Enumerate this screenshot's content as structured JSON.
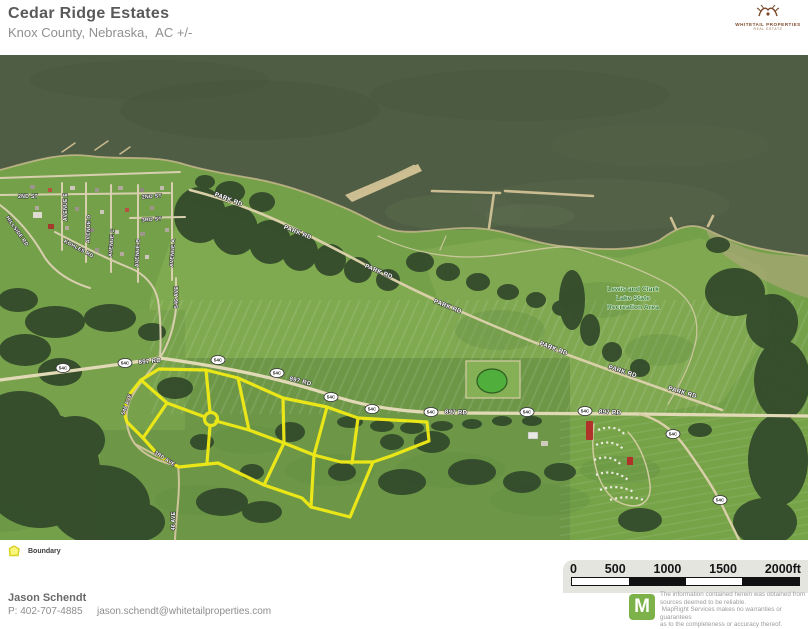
{
  "colors": {
    "boundary": "#f1eb16",
    "brand_green": "#7cb249",
    "logo_brown": "#7d4b2c",
    "rec_label_green": "#2e7d32",
    "water": "#4f5d44",
    "field": "#79a44c"
  },
  "header": {
    "title": "Cedar Ridge Estates",
    "subtitle": "Knox County, Nebraska,  AC +/-",
    "logo": {
      "line1": "WHITETAIL PROPERTIES",
      "line2": "REAL ESTATE"
    }
  },
  "map": {
    "shield_text": "54C",
    "shields": [
      {
        "x": 63,
        "y": 368
      },
      {
        "x": 125,
        "y": 363
      },
      {
        "x": 218,
        "y": 360
      },
      {
        "x": 277,
        "y": 373
      },
      {
        "x": 331,
        "y": 397
      },
      {
        "x": 372,
        "y": 409
      },
      {
        "x": 431,
        "y": 412
      },
      {
        "x": 527,
        "y": 412
      },
      {
        "x": 585,
        "y": 411
      },
      {
        "x": 673,
        "y": 434
      },
      {
        "x": 720,
        "y": 500
      }
    ],
    "labels": [
      {
        "t": "PARK RD",
        "x": 228,
        "y": 201,
        "r": 21,
        "s": 6.2
      },
      {
        "t": "PARK RD",
        "x": 297,
        "y": 234,
        "r": 22,
        "s": 6.2
      },
      {
        "t": "PARK RD",
        "x": 378,
        "y": 273,
        "r": 23,
        "s": 6.2
      },
      {
        "t": "PARK RD",
        "x": 447,
        "y": 308,
        "r": 22,
        "s": 6.2
      },
      {
        "t": "PARK RD",
        "x": 553,
        "y": 350,
        "r": 21,
        "s": 6.2
      },
      {
        "t": "PARK RD",
        "x": 622,
        "y": 373,
        "r": 18,
        "s": 6.2
      },
      {
        "t": "PARK RD",
        "x": 682,
        "y": 394,
        "r": 17,
        "s": 6.2
      },
      {
        "t": "897 RD",
        "x": 150,
        "y": 363,
        "r": -6,
        "s": 6.2
      },
      {
        "t": "897 RD",
        "x": 300,
        "y": 383,
        "r": 14,
        "s": 6.2
      },
      {
        "t": "897 RD",
        "x": 456,
        "y": 414,
        "r": 2,
        "s": 6.2
      },
      {
        "t": "897 RD",
        "x": 610,
        "y": 414,
        "r": 3,
        "s": 6.2
      },
      {
        "t": "2ND ST",
        "x": 28,
        "y": 198,
        "r": 0,
        "s": 5.2
      },
      {
        "t": "2ND ST",
        "x": 152,
        "y": 198,
        "r": -4,
        "s": 5.2
      },
      {
        "t": "3RD ST",
        "x": 152,
        "y": 221,
        "r": -4,
        "s": 5.2
      },
      {
        "t": "AVENUE E",
        "x": 67,
        "y": 207,
        "r": -90,
        "s": 5.2
      },
      {
        "t": "AVENUE D",
        "x": 90,
        "y": 229,
        "r": -88,
        "s": 5.2
      },
      {
        "t": "AVENUE C",
        "x": 113,
        "y": 243,
        "r": -85,
        "s": 5.2
      },
      {
        "t": "AVENUE B",
        "x": 139,
        "y": 253,
        "r": -87,
        "s": 5.2
      },
      {
        "t": "AVENUE A",
        "x": 174,
        "y": 253,
        "r": -86,
        "s": 5.2
      },
      {
        "t": "HILLSIDE RD",
        "x": 16,
        "y": 232,
        "r": 55,
        "s": 5.2
      },
      {
        "t": "KOHLES RD",
        "x": 78,
        "y": 250,
        "r": 28,
        "s": 5.2
      },
      {
        "t": "546 AVE",
        "x": 178,
        "y": 297,
        "r": -90,
        "s": 5.2
      },
      {
        "t": "546 AVE",
        "x": 128,
        "y": 405,
        "r": -70,
        "s": 5.2
      },
      {
        "t": "3RD AVE",
        "x": 164,
        "y": 460,
        "r": 33,
        "s": 5.2
      },
      {
        "t": "46 AVE",
        "x": 175,
        "y": 521,
        "r": -90,
        "s": 5.2
      }
    ],
    "rec_area": {
      "lines": [
        "Lewis and Clark",
        "Lake State",
        "Recreation Area"
      ],
      "x": 633,
      "y": 291,
      "lh": 9
    },
    "scalebar": {
      "labels": [
        "0",
        "500",
        "1000",
        "1500",
        "2000ft"
      ]
    }
  },
  "legend": {
    "items": [
      {
        "label": "Boundary"
      }
    ]
  },
  "footer": {
    "agent": "Jason Schendt",
    "phone": "P: 402-707-4885",
    "email": "jason.schendt@whitetailproperties.com",
    "brand_letter": "M",
    "disclaimer": [
      "The information contained herein was obtained from",
      "sources deemed to be reliable.",
      " MapRight Services makes no warranties or guarantees",
      "as to the completeness or accuracy thereof."
    ]
  }
}
